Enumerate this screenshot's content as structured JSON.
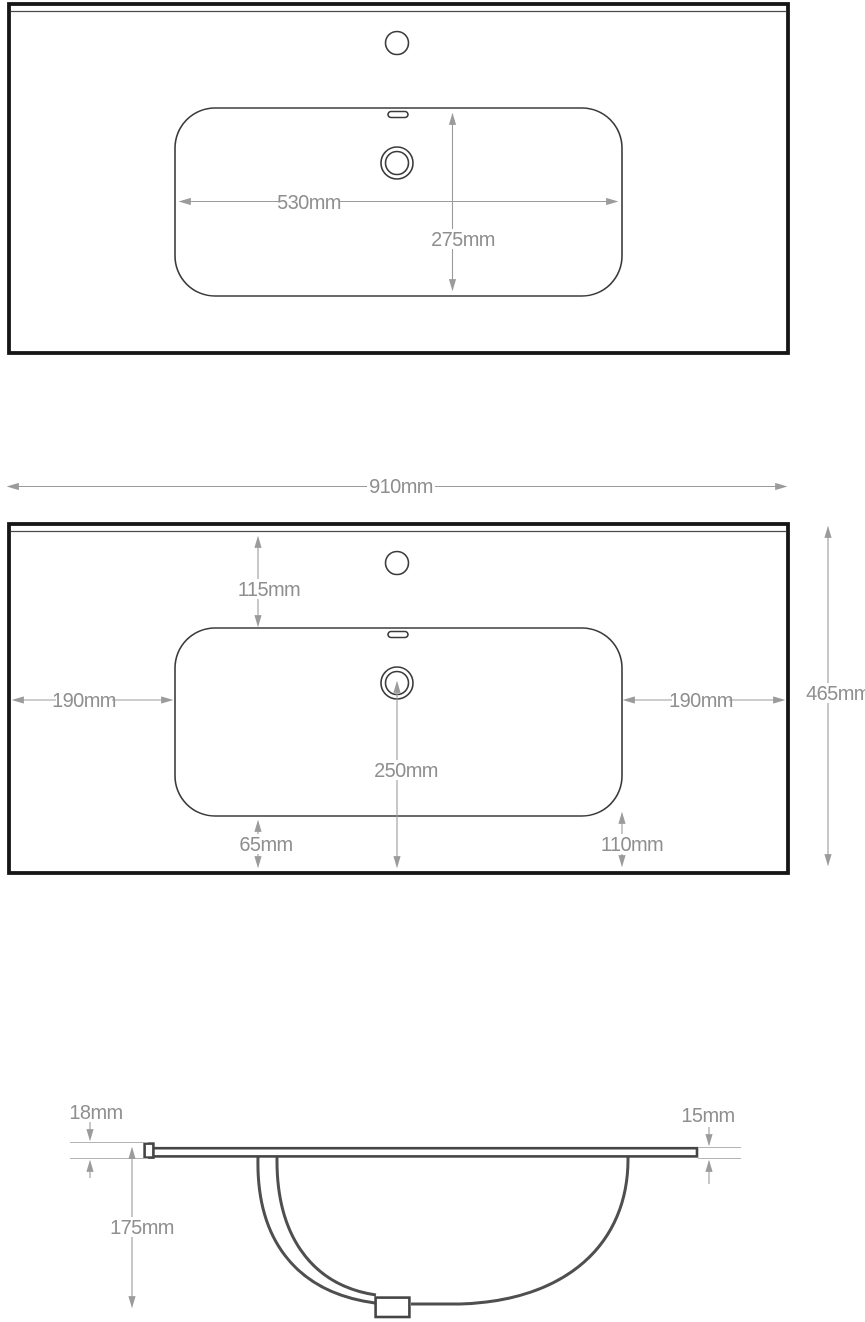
{
  "drawing": {
    "unit": "mm",
    "colors": {
      "outline": "#161616",
      "feature_line": "#3a3a3a",
      "section_line": "#4f4f4f",
      "dimension_line": "#9b9b9b",
      "dimension_text": "#8f8f8f",
      "background": "#ffffff"
    },
    "plan_view_basin": {
      "dims": {
        "basin_width": "530mm",
        "basin_depth": "275mm"
      }
    },
    "plan_view_worktop": {
      "dims": {
        "overall_width": "910mm",
        "overall_depth": "465mm",
        "basin_to_back": "115mm",
        "basin_to_left": "190mm",
        "basin_to_right": "190mm",
        "waste_to_front": "250mm",
        "basin_to_front_left": "65mm",
        "basin_to_front_right": "110mm"
      }
    },
    "section_view": {
      "dims": {
        "front_edge_height": "18mm",
        "worktop_thickness": "15mm",
        "bowl_depth": "175mm"
      }
    }
  }
}
